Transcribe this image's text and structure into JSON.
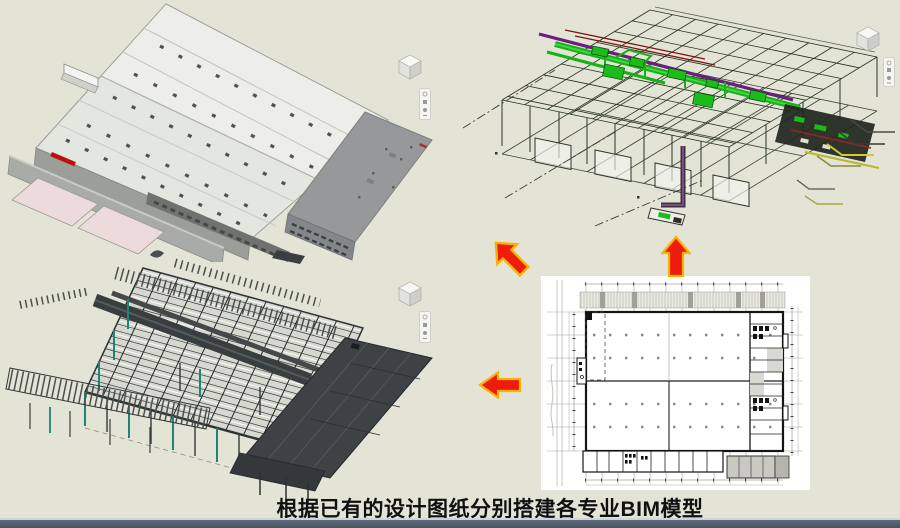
{
  "slide": {
    "background_color": "#e3e4d5",
    "caption": "根据已有的设计图纸分别搭建各专业BIM模型",
    "footer_bar_color": "#4d5c6a",
    "footer_edge_color": "#cfd4d6"
  },
  "arrows": {
    "fill": "#ee1c0d",
    "outline": "#f8b500",
    "items": [
      {
        "name": "arrow-to-architecture-model",
        "direction": "up-left"
      },
      {
        "name": "arrow-to-mep-model",
        "direction": "up"
      },
      {
        "name": "arrow-to-structure-model",
        "direction": "left"
      }
    ]
  },
  "panels": {
    "architecture_model": {
      "kind": "3d-architecture-bim-model",
      "roof_color": "#edeee9",
      "wall_color": "#9b9e99",
      "annex_roof_color": "#96989a",
      "ramp_color": "#eddbdc",
      "logo_color": "#bb1111"
    },
    "mep_model": {
      "kind": "3d-mep-bim-model",
      "duct_color": "#15b315",
      "pipe_color": "#6b1d80",
      "wire_color": "#25301f",
      "accent_red": "#7a1412",
      "accent_yellow": "#c2c233"
    },
    "structure_model": {
      "kind": "3d-steel-structure-bim-model",
      "steel_color": "#3f4446",
      "column_color": "#1f8575",
      "deck_color": "#d7d8d0"
    },
    "floor_plan": {
      "kind": "2d-design-drawing",
      "paper_color": "#ffffff",
      "wall_color": "#151515",
      "grid_color": "#a6a69e"
    }
  },
  "viewcubes": [
    {
      "name": "viewcube-architecture"
    },
    {
      "name": "viewcube-mep"
    },
    {
      "name": "viewcube-structure"
    }
  ]
}
